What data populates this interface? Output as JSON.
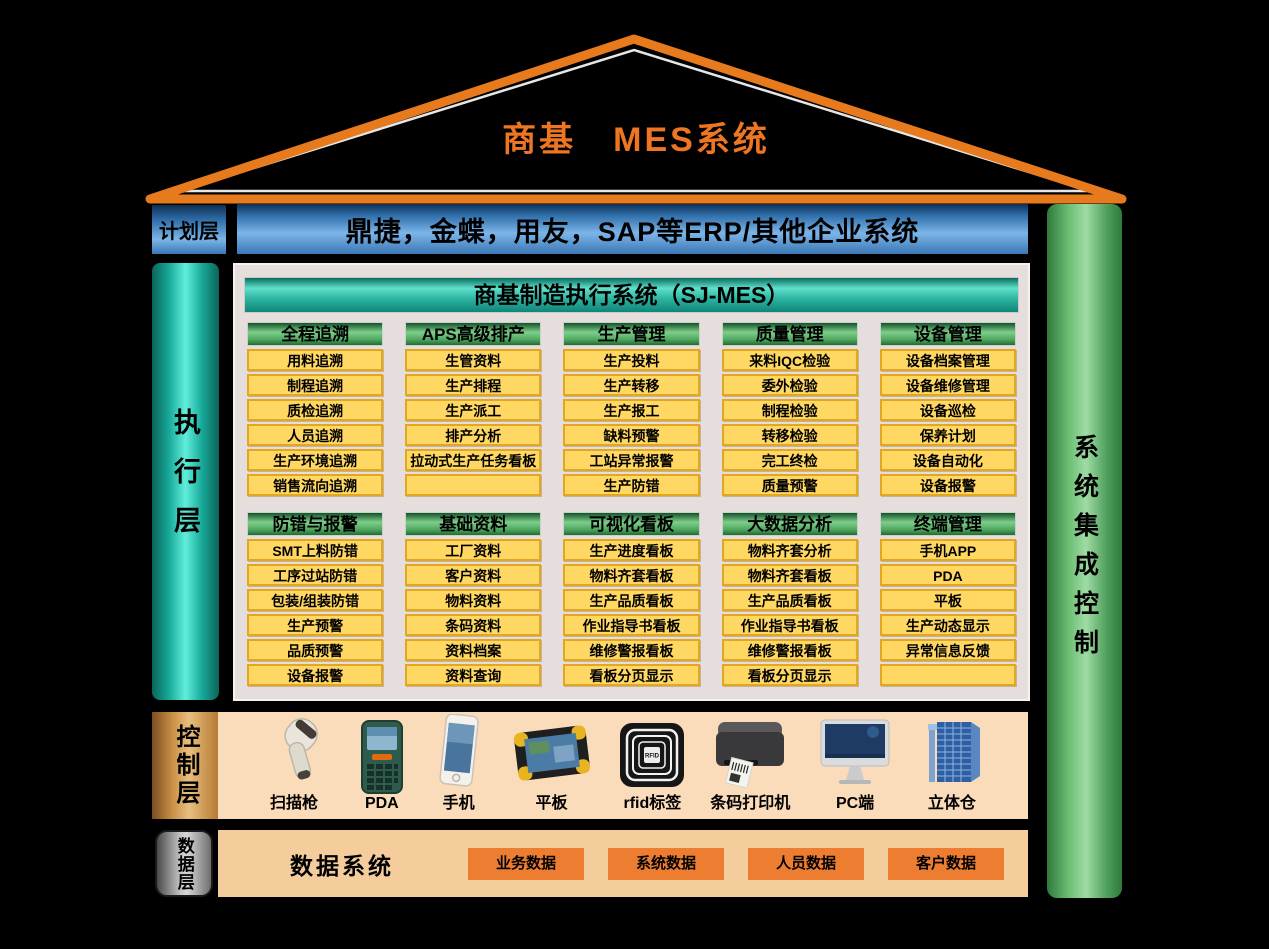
{
  "title": "商基　MES系统",
  "erp_bar": {
    "text": "鼎捷，金蝶，用友，SAP等ERP/其他企业系统"
  },
  "right_bar": {
    "label": "系统集成控制"
  },
  "layers": {
    "plan": {
      "label": "计划层"
    },
    "execute": {
      "label": "执行层"
    },
    "control": {
      "label": "控制层"
    },
    "data": {
      "label": "数据层"
    }
  },
  "execution": {
    "header": "商基制造执行系统（SJ-MES）",
    "sections": [
      {
        "columns": [
          {
            "header": "全程追溯",
            "items": [
              "用料追溯",
              "制程追溯",
              "质检追溯",
              "人员追溯",
              "生产环境追溯",
              "销售流向追溯"
            ]
          },
          {
            "header": "APS高级排产",
            "items": [
              "生管资料",
              "生产排程",
              "生产派工",
              "排产分析",
              "拉动式生产任务看板",
              ""
            ]
          },
          {
            "header": "生产管理",
            "items": [
              "生产投料",
              "生产转移",
              "生产报工",
              "缺料预警",
              "工站异常报警",
              "生产防错"
            ]
          },
          {
            "header": "质量管理",
            "items": [
              "来料IQC检验",
              "委外检验",
              "制程检验",
              "转移检验",
              "完工终检",
              "质量预警"
            ]
          },
          {
            "header": "设备管理",
            "items": [
              "设备档案管理",
              "设备维修管理",
              "设备巡检",
              "保养计划",
              "设备自动化",
              "设备报警"
            ]
          }
        ]
      },
      {
        "columns": [
          {
            "header": "防错与报警",
            "items": [
              "SMT上料防错",
              "工序过站防错",
              "包装/组装防错",
              "生产预警",
              "品质预警",
              "设备报警"
            ]
          },
          {
            "header": "基础资料",
            "items": [
              "工厂资料",
              "客户资料",
              "物料资料",
              "条码资料",
              "资料档案",
              "资料查询"
            ]
          },
          {
            "header": "可视化看板",
            "items": [
              "生产进度看板",
              "物料齐套看板",
              "生产品质看板",
              "作业指导书看板",
              "维修警报看板",
              "看板分页显示"
            ]
          },
          {
            "header": "大数据分析",
            "items": [
              "物料齐套分析",
              "物料齐套看板",
              "生产品质看板",
              "作业指导书看板",
              "维修警报看板",
              "看板分页显示"
            ]
          },
          {
            "header": "终端管理",
            "items": [
              "手机APP",
              "PDA",
              "平板",
              "生产动态显示",
              "异常信息反馈",
              ""
            ]
          }
        ]
      }
    ]
  },
  "control_layer": {
    "devices": [
      {
        "label": "扫描枪",
        "icon": "scanner-icon"
      },
      {
        "label": "PDA",
        "icon": "pda-icon"
      },
      {
        "label": "手机",
        "icon": "phone-icon"
      },
      {
        "label": "平板",
        "icon": "tablet-icon"
      },
      {
        "label": "rfid标签",
        "icon": "rfid-tag-icon"
      },
      {
        "label": "条码打印机",
        "icon": "barcode-printer-icon"
      },
      {
        "label": "PC端",
        "icon": "pc-icon"
      },
      {
        "label": "立体仓",
        "icon": "warehouse-icon"
      }
    ]
  },
  "data_layer": {
    "system_label": "数据系统",
    "chips": [
      "业务数据",
      "系统数据",
      "人员数据",
      "客户数据"
    ]
  },
  "colors": {
    "roof_orange": "#E87A1E",
    "title_orange": "#EE7623",
    "module_yellow": "#FFD763",
    "module_green": "#4FA860",
    "panel_teal": "#2BB3A0",
    "chip_orange": "#ED7D31",
    "right_bar_green": "#9FDCA4"
  }
}
